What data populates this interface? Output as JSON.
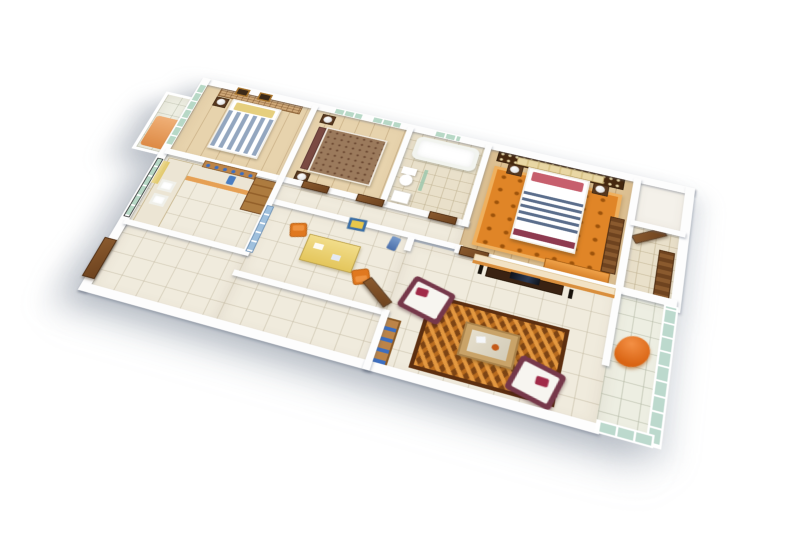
{
  "image": {
    "kind": "3d-isometric-floor-plan-render",
    "background_color": "#ffffff",
    "visible_text": "none"
  },
  "palette": {
    "wall": "#ffffff",
    "floor_tile": "#f0ebdd",
    "floor_wood": "#e7d3ad",
    "glass_green": "#b7d8c6",
    "door_brown": "#6e431f",
    "rug_master_orange": "#e08527",
    "rug_living_brown": "#7d4414",
    "sofa_maroon": "#76384a",
    "bed_stripe_navy": "#5b6e8c",
    "dining_table_yellow": "#ecd06e",
    "chair_orange": "#e0781f",
    "lounge_orange": "#e57722",
    "counter_wood": "#ad7b3f"
  },
  "rooms": [
    {
      "label": "small balcony with orange bench"
    },
    {
      "label": "bedroom with blue striped bed, two wall pictures, sliding glass wall"
    },
    {
      "label": "bedroom with brown bed and two lamps"
    },
    {
      "label": "bathroom with tub, toilet and sink"
    },
    {
      "label": "master bedroom with lattice headboard wall, striped bed, orange rug"
    },
    {
      "label": "utility room (empty)"
    },
    {
      "label": "dressing passage with wardrobe and open door"
    },
    {
      "label": "corridor with doors"
    },
    {
      "label": "kitchen with counters, double sink and dish shelf"
    },
    {
      "label": "dining area with yellow table and orange chairs"
    },
    {
      "label": "living room with two sofas, coffee table, patterned rug and TV wall"
    },
    {
      "label": "entrance foyer with double door"
    },
    {
      "label": "main balcony with orange lounge chair and glass enclosure"
    }
  ],
  "furniture": {
    "beds": [
      "blue-white striped bed with yellow pillows",
      "brown fabric bed with maroon headboard",
      "white bed with navy stripe band and rose pillows"
    ],
    "living": [
      "white-maroon sofa x2",
      "glass-top coffee table",
      "TV console with flat TV",
      "bookshelf with blue books"
    ],
    "kitchen": [
      "L-counter with twin sinks",
      "wall shelf with blue dishes",
      "tall cabinet",
      "yellow curtain"
    ],
    "dining": [
      "yellow dining table",
      "orange chair x2",
      "blue framed wall art"
    ],
    "bath": [
      "bathtub",
      "toilet",
      "washbasin",
      "green glass partition"
    ],
    "balcony": [
      "orange lounge chair",
      "orange bench"
    ]
  }
}
